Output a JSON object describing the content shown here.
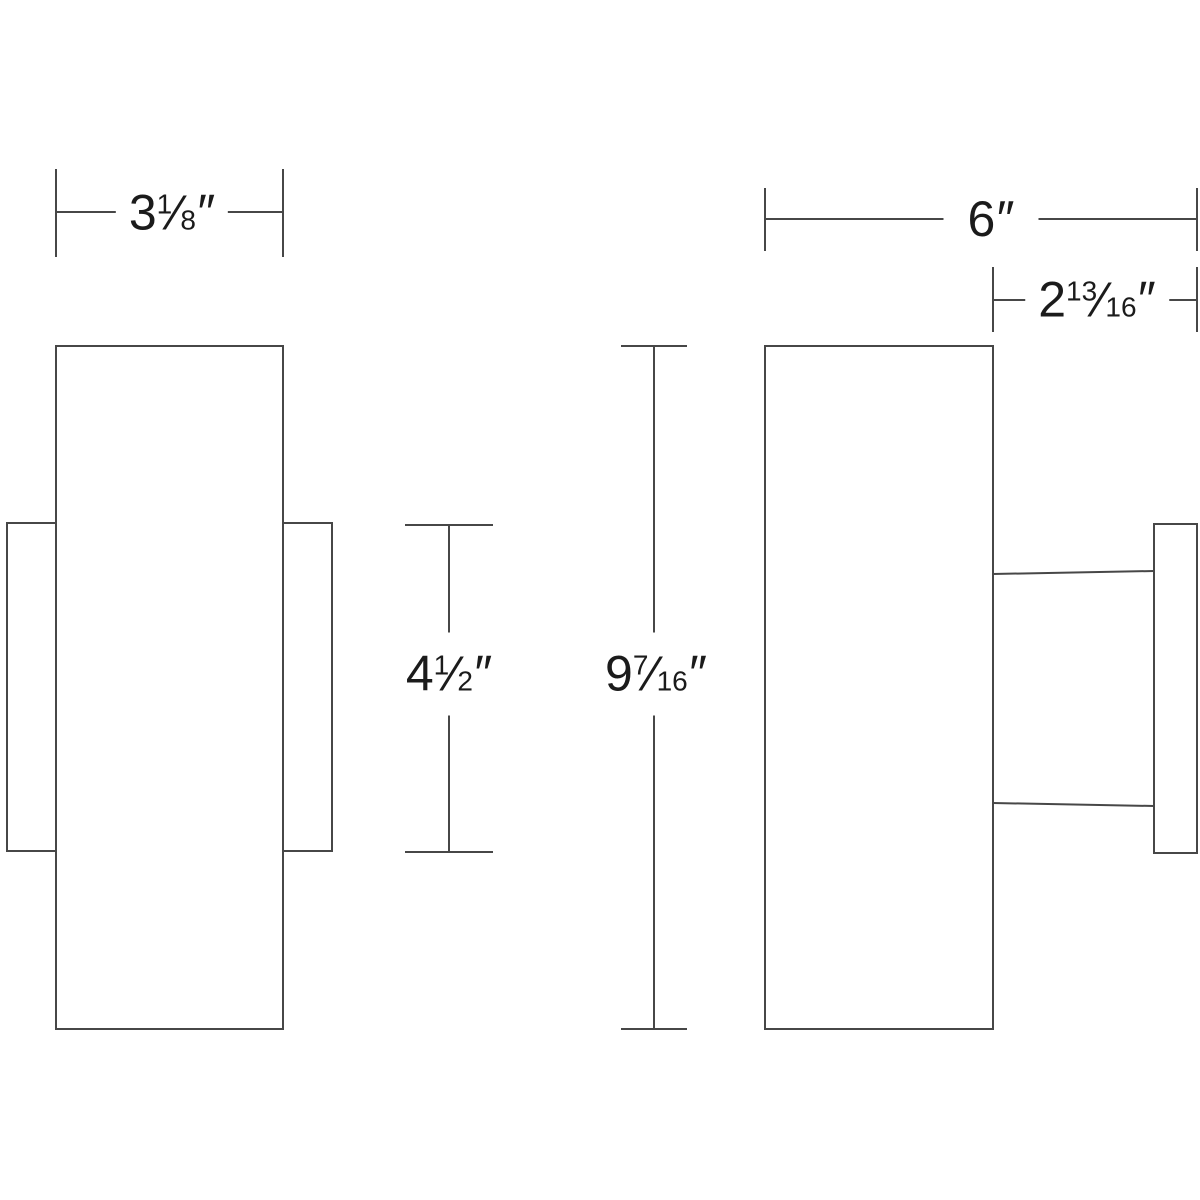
{
  "style": {
    "background": "#ffffff",
    "line_color": "#474747",
    "text_color": "#1b1b1b"
  },
  "dimensions": {
    "front_width": {
      "whole": "3",
      "num": "1",
      "slash": "⁄",
      "den": "8",
      "unit": "″"
    },
    "overall_depth": {
      "whole": "6",
      "unit": "″"
    },
    "extension": {
      "whole": "2",
      "num": "13",
      "slash": "⁄",
      "den": "16",
      "unit": "″"
    },
    "backplate_height": {
      "whole": "4",
      "num": "1",
      "slash": "⁄",
      "den": "2",
      "unit": "″"
    },
    "overall_height": {
      "whole": "9",
      "num": "7",
      "slash": "⁄",
      "den": "16",
      "unit": "″"
    }
  }
}
